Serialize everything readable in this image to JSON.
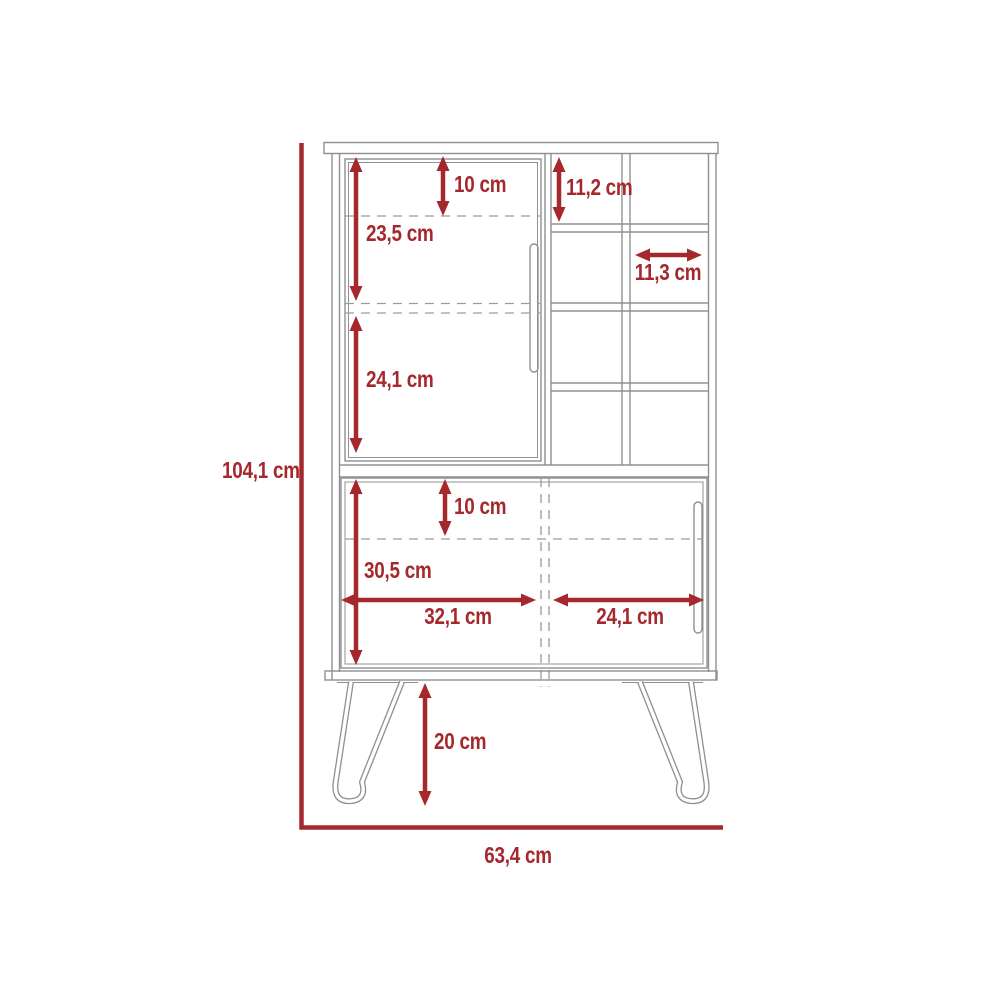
{
  "diagram": {
    "kind": "furniture-dimension-drawing",
    "subject": "bar cabinet with door, cubby shelves, sliding lower doors and hairpin legs",
    "unit": "cm",
    "colors": {
      "dimension_accent": "#A5282D",
      "outline_gray": "#8d9093",
      "background": "#ffffff"
    }
  },
  "dimensions": {
    "overall_height": {
      "label": "104,1 cm"
    },
    "overall_width": {
      "label": "63,4 cm"
    },
    "upper_top_offset": {
      "label": "10 cm"
    },
    "upper_shelf_first": {
      "label": "23,5 cm"
    },
    "upper_shelf_second": {
      "label": "24,1 cm"
    },
    "cubby_height": {
      "label": "11,2 cm"
    },
    "cubby_width": {
      "label": "11,3 cm"
    },
    "lower_top_offset": {
      "label": "10 cm"
    },
    "lower_cabinet_height": {
      "label": "30,5 cm"
    },
    "lower_left_width": {
      "label": "32,1 cm"
    },
    "lower_right_width": {
      "label": "24,1 cm"
    },
    "leg_height": {
      "label": "20 cm"
    }
  }
}
